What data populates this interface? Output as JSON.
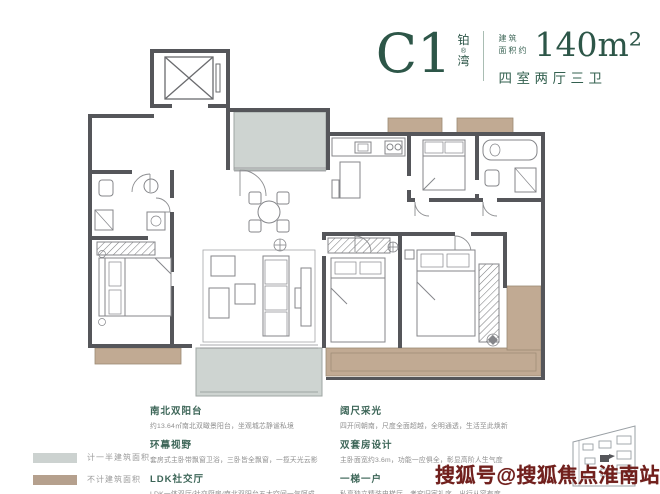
{
  "header": {
    "unit_code": "C1",
    "brand_top": "铂",
    "brand_reg": "®",
    "brand_bottom": "湾",
    "area_label_line1": "建筑",
    "area_label_line2": "面积约",
    "area_value": "140m²",
    "rooms_desc": "四室两厅三卫"
  },
  "legend": {
    "items": [
      {
        "label": "计一半建筑面积",
        "color": "#ccd2d0"
      },
      {
        "label": "不计建筑面积",
        "color": "#b5a08d"
      }
    ]
  },
  "features_left": [
    {
      "title": "南北双阳台",
      "desc": "约13.64㎡南北双瞰景阳台，坐观城芯静谧私境"
    },
    {
      "title": "环幕视野",
      "desc": "套房式主卧带飘窗卫浴，三卧皆全飘窗，一揽天光云影"
    },
    {
      "title": "LDK社交厅",
      "desc": "LDK一体双厅/社交厨房/南北双阳台五大空间一气呵成"
    }
  ],
  "features_right": [
    {
      "title": "阔尺采光",
      "desc": "四开间朝南，尺度全面超越，全明通透，生活至此焕新"
    },
    {
      "title": "双套房设计",
      "desc": "主卧面宽约3.6m，功能一应俱全，彰显高阶人生气度"
    },
    {
      "title": "一梯一户",
      "desc": "私享独立精装电梯厅，考究归家礼序，出行从容有度"
    }
  ],
  "watermark": "搜狐号@搜狐焦点淮南站",
  "icons": {
    "floor_plan": "floor-plan-drawing",
    "elevator": "elevator-shaft-icon",
    "building_sketch": "building-outline-sketch"
  },
  "colors": {
    "accent_green": "#2d5648",
    "feature_title_green": "#3c6557",
    "text_gray": "#8e8e8e",
    "wall_gray": "#55565a",
    "balcony_gray": "#ced4d1",
    "bay_window_tan": "#c1aa93",
    "watermark_red": "#71201d"
  }
}
